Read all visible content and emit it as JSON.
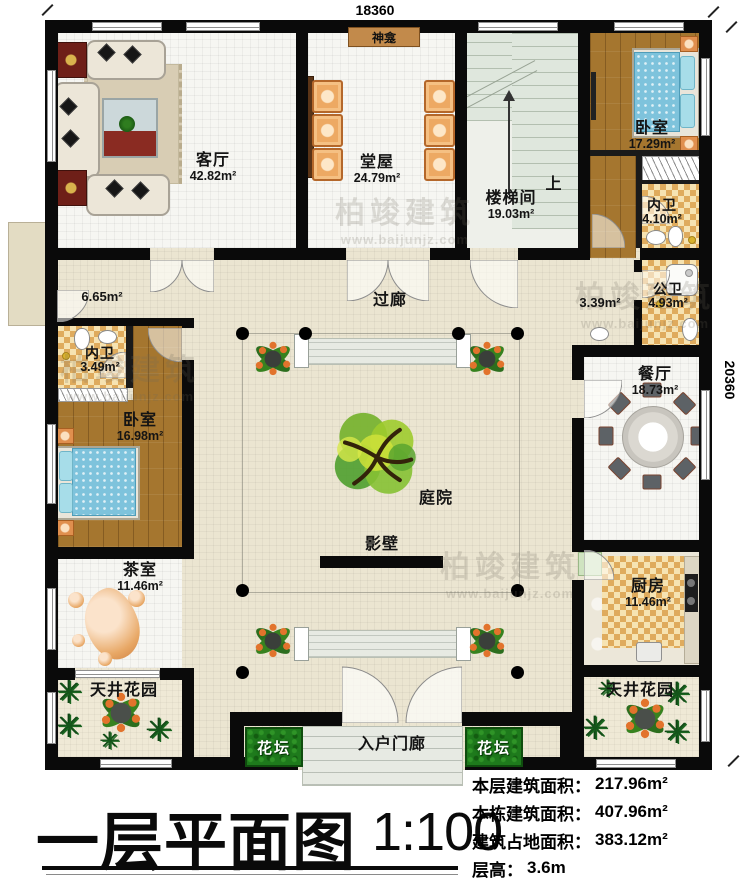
{
  "dimensions": {
    "top": "18360",
    "right": "20360"
  },
  "rooms": {
    "living": {
      "name": "客厅",
      "area": "42.82m²"
    },
    "tangwu": {
      "name": "堂屋",
      "area": "24.79m²"
    },
    "shrine": {
      "name": "神龛"
    },
    "stairwell": {
      "name": "楼梯间",
      "area": "19.03m²",
      "up": "上"
    },
    "bedroom_tr": {
      "name": "卧室",
      "area": "17.29m²"
    },
    "neiwei_tr": {
      "name": "内卫",
      "area": "4.10m²"
    },
    "gongwei": {
      "name": "公卫",
      "area": "4.93m²"
    },
    "vestibule": {
      "area": "3.39m²"
    },
    "balcony": {
      "area": "6.65m²"
    },
    "dining": {
      "name": "餐厅",
      "area": "18.73m²"
    },
    "kitchen": {
      "name": "厨房",
      "area": "11.46m²"
    },
    "patio_r": {
      "name": "天井花园"
    },
    "patio_l": {
      "name": "天井花园"
    },
    "neiwei_l": {
      "name": "内卫",
      "area": "3.49m²"
    },
    "bedroom_l": {
      "name": "卧室",
      "area": "16.98m²"
    },
    "tea": {
      "name": "茶室",
      "area": "11.46m²"
    },
    "corridor": {
      "name": "过廊"
    },
    "courtyard": {
      "name": "庭院"
    },
    "screen_wall": {
      "name": "影壁"
    },
    "porch": {
      "name": "入户门廊"
    },
    "flowerbed_l": {
      "name": "花坛"
    },
    "flowerbed_r": {
      "name": "花坛"
    }
  },
  "title": {
    "text": "一层平面图",
    "scale": "1:100"
  },
  "stats": {
    "rows": [
      {
        "label": "本层建筑面积：",
        "value": "217.96m²"
      },
      {
        "label": "本栋建筑面积：",
        "value": "407.96m²"
      },
      {
        "label": "建筑占地面积：",
        "value": "383.12m²"
      },
      {
        "label": "层高：",
        "value": "3.6m"
      }
    ]
  },
  "watermark": {
    "brand": "柏竣建筑",
    "url": "www.baijunjz.com"
  },
  "colors": {
    "wall": "#0a0a0a",
    "floor_cream": "#ebe5d1",
    "room_white": "#f6f6f2",
    "wood": "#a5762f",
    "tile_check": "#dfab5d",
    "bed_blue": "#7ec3dc",
    "flowerbed_green": "#1e7a1c",
    "tree_green": "#6fae2e",
    "shrine_tan": "#c28a4b"
  }
}
